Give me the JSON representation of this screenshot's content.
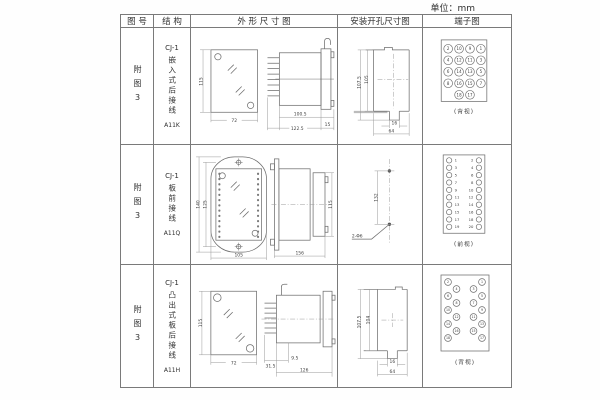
{
  "unit_label": "单位：mm",
  "headers": {
    "fig_no": "图 号",
    "structure": "结 构",
    "outline": "外 形 尺 寸 图",
    "install": "安装开孔尺寸图",
    "terminal": "端子图"
  },
  "rows": [
    {
      "fig_no": "附图3",
      "series": "CJ-1",
      "structure": "嵌入式后接线",
      "model": "A11K",
      "outline_dims": {
        "h": "115",
        "w": "72",
        "body": "100.5",
        "total": "122.5",
        "flange": "15"
      },
      "install_dims": {
        "v_outer": "107.5",
        "v_inner": "105",
        "slot": "16",
        "width": "64"
      },
      "terminal_label": "(背视)"
    },
    {
      "fig_no": "附图3",
      "series": "CJ-1",
      "structure": "板前接线",
      "model": "A11Q",
      "outline_dims": {
        "h_outer": "140",
        "h_inner": "125",
        "w": "105",
        "length": "156",
        "side_h": "115"
      },
      "install_dims": {
        "spacing": "132",
        "holes": "2-Φ6"
      },
      "terminal_label": "(前视)"
    },
    {
      "fig_no": "附图3",
      "series": "CJ-1",
      "structure": "凸出式板后接线",
      "model": "A11H",
      "outline_dims": {
        "h": "115",
        "w": "72",
        "pins": "31.5",
        "step": "9.5",
        "length": "126"
      },
      "install_dims": {
        "v_outer": "107.5",
        "v_inner": "104",
        "slot": "16",
        "width": "64"
      },
      "terminal_label": "(背视)"
    }
  ],
  "terminals": {
    "a11k_back": [
      [
        2,
        10,
        9,
        1
      ],
      [
        4,
        12,
        11,
        3
      ],
      [
        6,
        14,
        13,
        5
      ],
      [
        8,
        16,
        15,
        7
      ],
      [
        18,
        17
      ]
    ],
    "a11q_front_left": [
      1,
      3,
      5,
      7,
      9,
      11,
      13,
      15,
      17,
      19
    ],
    "a11q_front_right": [
      2,
      4,
      6,
      8,
      10,
      12,
      14,
      16,
      18,
      20
    ],
    "a11h_back": {
      "left_outer": [
        2,
        6,
        10,
        14,
        18
      ],
      "left_inner": [
        4,
        8,
        12,
        16
      ],
      "right_inner": [
        3,
        7,
        11,
        15
      ],
      "right_outer": [
        1,
        5,
        9,
        13,
        17
      ]
    }
  },
  "colors": {
    "line": "#6e6e6e",
    "dim": "#989898",
    "text": "#3f3f3f",
    "border": "#7a7a7a",
    "background": "#ffffff"
  }
}
